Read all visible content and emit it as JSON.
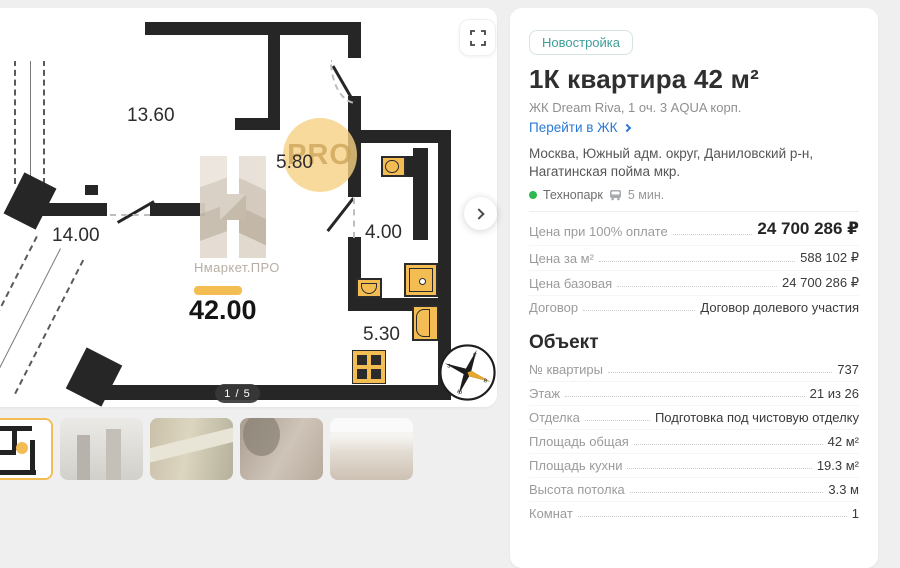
{
  "colors": {
    "accent": "#f3bd53",
    "teal": "#3f9e98",
    "blue": "#2878d6",
    "green": "#2eb84d"
  },
  "plan": {
    "labels": {
      "living": "13.60",
      "kitchen": "14.00",
      "hall": "5.80",
      "bath": "4.00",
      "laundry": "5.30",
      "total_area": "42.00"
    },
    "watermark_name": "Нмаркет.ПРО",
    "watermark_pro": "PRO",
    "page_indicator": "1 / 5",
    "compass": {
      "n": "с",
      "e": "в",
      "s": "ю",
      "w": "з"
    }
  },
  "gallery": {
    "thumbs": [
      {
        "name": "floor-plan-thumb",
        "kind": "plan",
        "selected": true
      },
      {
        "name": "exterior-towers-thumb",
        "kind": "exterior",
        "selected": false
      },
      {
        "name": "aerial-view-thumb",
        "kind": "aerial",
        "selected": false
      },
      {
        "name": "interior-living-thumb",
        "kind": "living",
        "selected": false
      },
      {
        "name": "interior-kitchen-thumb",
        "kind": "kitchen",
        "selected": false
      }
    ]
  },
  "details": {
    "badge": "Новостройка",
    "title": "1К квартира 42 м²",
    "subtitle": "ЖК Dream Riva, 1 оч. 3 AQUA корп.",
    "link_label": "Перейти в ЖК",
    "address": "Москва, Южный адм. округ, Даниловский р-н, Нагатинская пойма мкр.",
    "metro": {
      "station": "Технопарк",
      "walk_time": "5 мин."
    },
    "prices": [
      {
        "label": "Цена при 100% оплате",
        "value": "24 700 286 ₽",
        "primary": true
      },
      {
        "label": "Цена за м²",
        "value": "588 102 ₽",
        "primary": false
      },
      {
        "label": "Цена базовая",
        "value": "24 700 286 ₽",
        "primary": false
      },
      {
        "label": "Договор",
        "value": "Договор долевого участия",
        "primary": false
      }
    ],
    "object_heading": "Объект",
    "object": [
      {
        "label": "№ квартиры",
        "value": "737"
      },
      {
        "label": "Этаж",
        "value": "21 из 26"
      },
      {
        "label": "Отделка",
        "value": "Подготовка под чистовую отделку"
      },
      {
        "label": "Площадь общая",
        "value": "42 м²"
      },
      {
        "label": "Площадь кухни",
        "value": "19.3 м²"
      },
      {
        "label": "Высота потолка",
        "value": "3.3 м"
      },
      {
        "label": "Комнат",
        "value": "1"
      }
    ]
  }
}
